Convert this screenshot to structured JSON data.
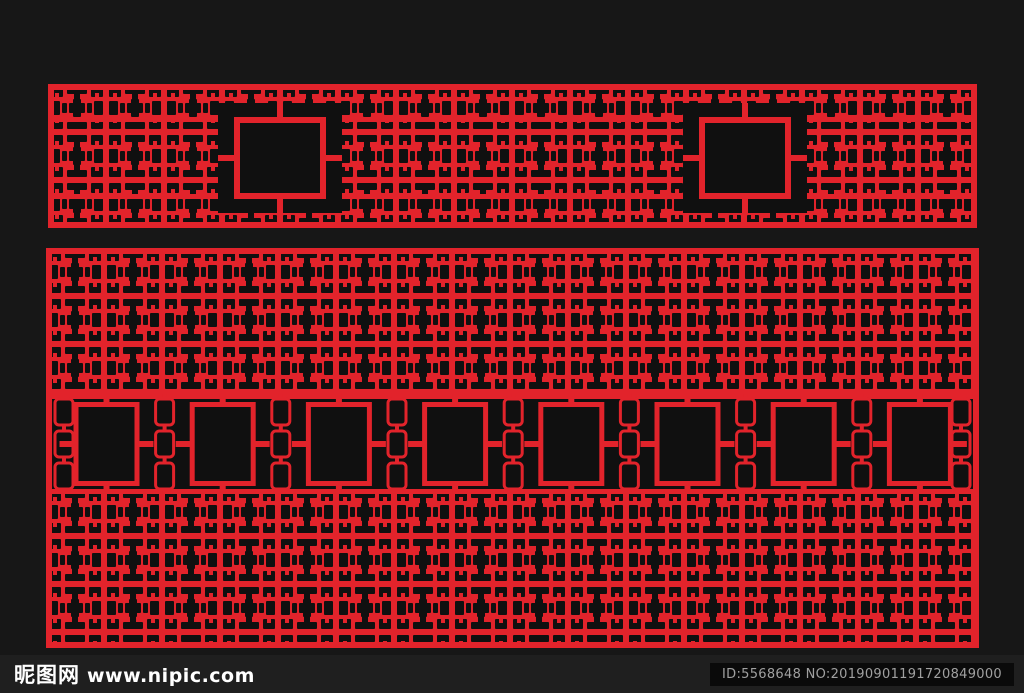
{
  "page": {
    "background_color": "#171717",
    "bar_color": "#1f1f1f"
  },
  "artwork": {
    "description": "Chinese traditional lattice grille pattern, red on black",
    "accent_color": "#e2232b",
    "ink_color": "#101010",
    "top_panel": {
      "openings": 2
    },
    "bottom_panel": {
      "openings": 8
    }
  },
  "footer": {
    "site_name": "昵图网",
    "site_url": "www.nipic.com",
    "image_id": "ID:5568648 NO:20190901191720849000"
  }
}
